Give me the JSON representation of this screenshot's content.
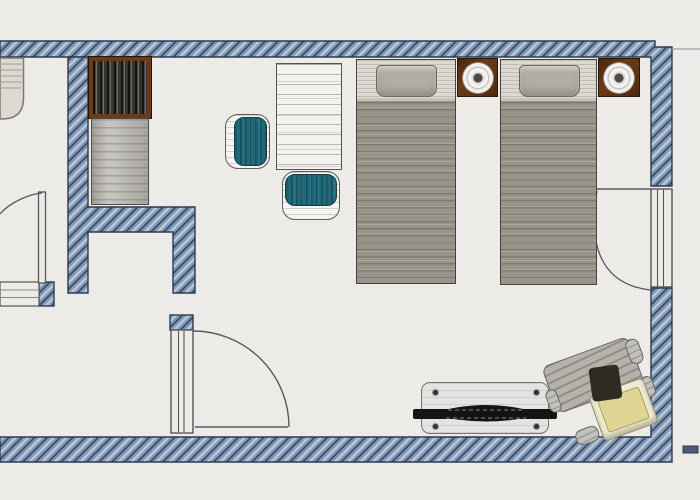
{
  "document": {
    "type": "floor-plan",
    "subject": "hotel twin-bed room, hand-drawn architectural style",
    "text_content": "none (drawing only)"
  },
  "palette": {
    "paper": "#edebe7",
    "outline": "#2c3a52",
    "wall_line": "#32486a",
    "wall_mid": "#7f97b3",
    "wall_light": "#bcc8d5",
    "ink": "#57595d",
    "bed_blanket": "#98948a",
    "bed_sheet": "#dbd9d2",
    "pillow": "#b0ada3",
    "wood": "#6e3a16",
    "closet_dark": "#35332f",
    "furn_gray": "#b7b4ae",
    "teal": "#20697b",
    "bench_body": "#e3e3e1",
    "strap": "#141414",
    "cushion": "#ded592",
    "chair_gray": "#b5b2ac"
  },
  "rooms": [
    {
      "name": "bedroom",
      "contents": [
        "two twin beds",
        "two nightstands with lamps",
        "desk",
        "two teal chairs",
        "luggage bench",
        "armchair"
      ]
    },
    {
      "name": "entry-niche",
      "contents": [
        "wardrobe",
        "dresser"
      ]
    },
    {
      "name": "bathroom-partial",
      "contents": [
        "washbasin (cut off at left edge)",
        "counter ledge",
        "swing door"
      ]
    }
  ],
  "openings": {
    "entry_door": {
      "label": "interior swing door, opens right",
      "wall": "bottom"
    },
    "bathroom_door": {
      "label": "bathroom swing door, partially visible",
      "wall": "left edge"
    },
    "balcony_door": {
      "label": "window / balcony door with swing arc",
      "wall": "right"
    }
  },
  "furniture": {
    "sink": {
      "label": "washbasin (partial)"
    },
    "counter": {
      "label": "counter ledge with wall stub"
    },
    "wardrobe": {
      "label": "wardrobe with hanging clothes",
      "rect": [
        89,
        57,
        62,
        61
      ]
    },
    "dresser": {
      "label": "dresser",
      "rect": [
        91,
        118,
        58,
        87
      ]
    },
    "desk": {
      "label": "desk / table",
      "rect": [
        276,
        63,
        66,
        107
      ]
    },
    "chair_left": {
      "label": "teal chair facing right",
      "rect": [
        225,
        114,
        45,
        55
      ]
    },
    "chair_bottom": {
      "label": "teal chair facing up",
      "rect": [
        282,
        171,
        58,
        49
      ]
    },
    "bed_left": {
      "label": "twin bed",
      "rect": [
        356,
        59,
        100,
        225
      ]
    },
    "bed_right": {
      "label": "twin bed",
      "rect": [
        500,
        59,
        97,
        226
      ]
    },
    "nightstand_left": {
      "label": "nightstand with round lamp",
      "rect": [
        457,
        58,
        41,
        39
      ]
    },
    "nightstand_right": {
      "label": "nightstand with round lamp",
      "rect": [
        598,
        58,
        42,
        39
      ]
    },
    "luggage_bench": {
      "label": "folding luggage bench with black straps",
      "rect": [
        421,
        382,
        128,
        52
      ]
    },
    "armchair": {
      "label": "armchair with pale-yellow cushion, rotated",
      "rect": [
        552,
        346,
        100,
        96
      ],
      "rotation_deg": -20
    }
  }
}
